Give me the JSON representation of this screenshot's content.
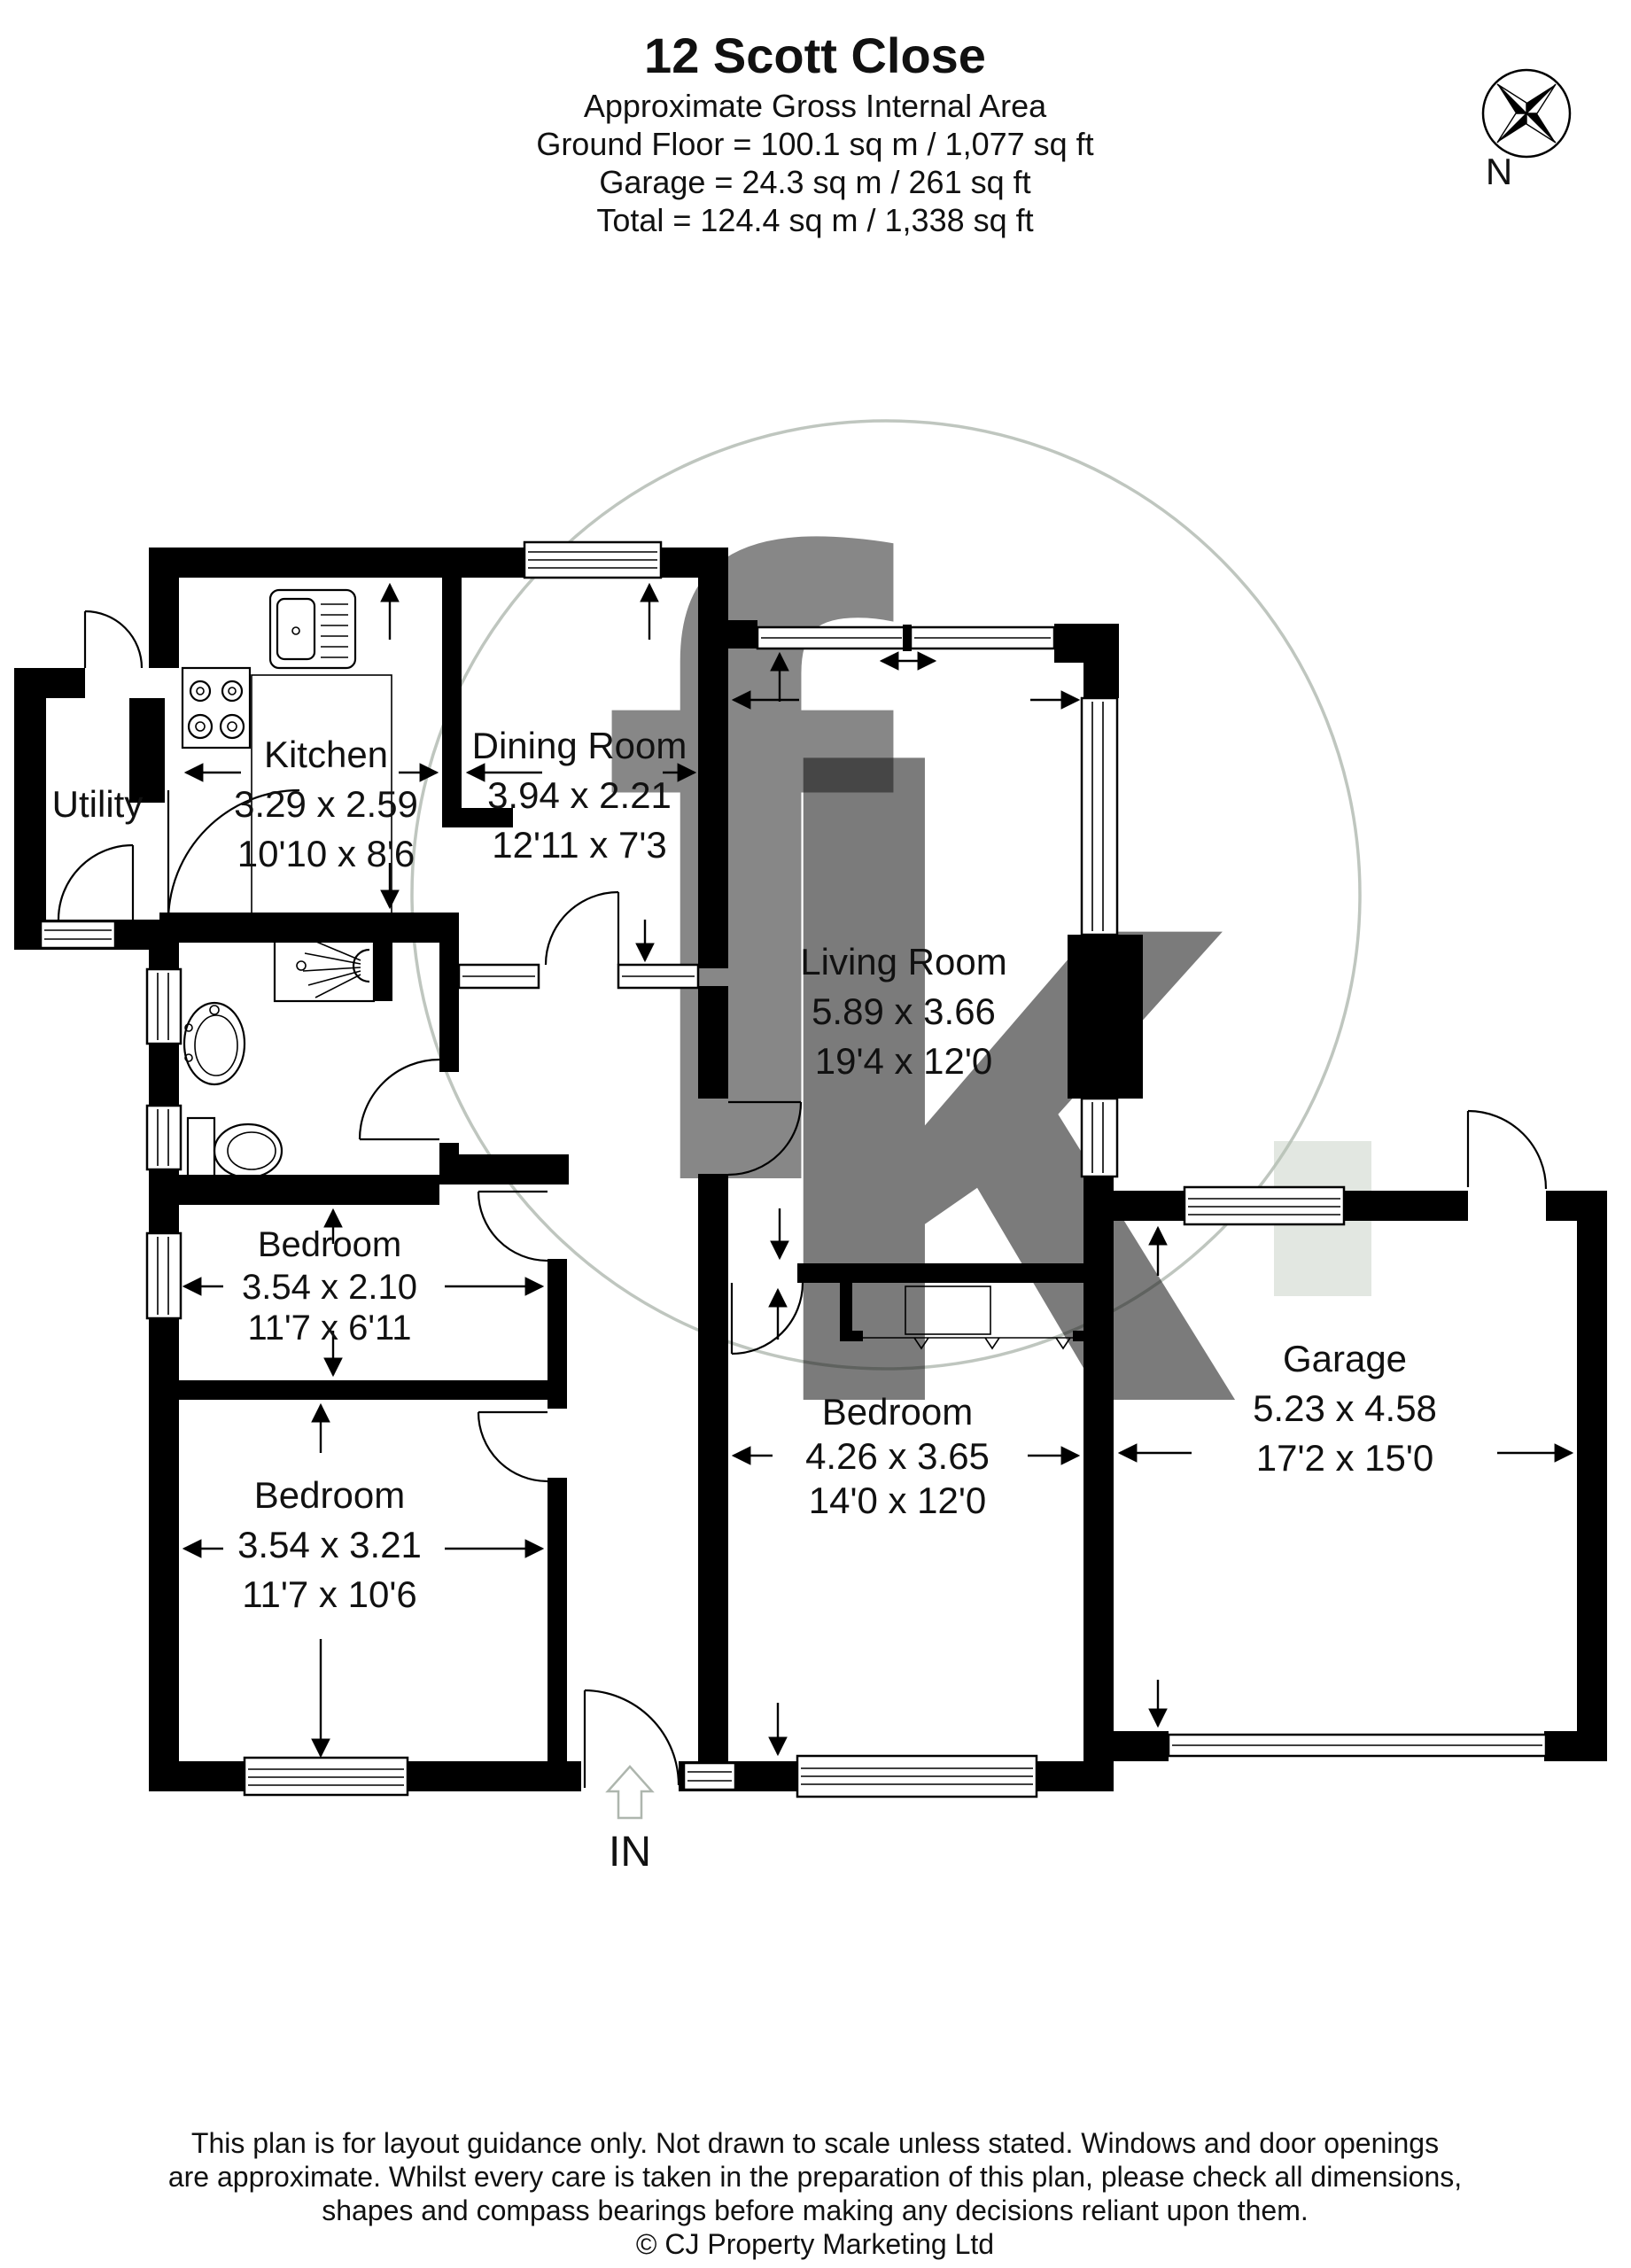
{
  "header": {
    "title": "12 Scott Close",
    "subtitle": "Approximate Gross Internal Area",
    "area_lines": [
      "Ground Floor = 100.1 sq m / 1,077 sq ft",
      "Garage = 24.3 sq m / 261 sq ft",
      "Total = 124.4 sq m / 1,338 sq ft"
    ]
  },
  "compass": {
    "label": "N"
  },
  "rooms": {
    "utility": {
      "name": "Utility"
    },
    "kitchen": {
      "name": "Kitchen",
      "metric": "3.29 x 2.59",
      "imperial": "10'10 x 8'6"
    },
    "dining": {
      "name": "Dining Room",
      "metric": "3.94 x 2.21",
      "imperial": "12'11 x 7'3"
    },
    "living": {
      "name": "Living Room",
      "metric": "5.89 x 3.66",
      "imperial": "19'4 x 12'0"
    },
    "bedroom1": {
      "name": "Bedroom",
      "metric": "3.54 x 2.10",
      "imperial": "11'7 x 6'11"
    },
    "bedroom2": {
      "name": "Bedroom",
      "metric": "3.54 x 3.21",
      "imperial": "11'7 x 10'6"
    },
    "bedroom3": {
      "name": "Bedroom",
      "metric": "4.26 x 3.65",
      "imperial": "14'0 x 12'0"
    },
    "garage": {
      "name": "Garage",
      "metric": "5.23 x 4.58",
      "imperial": "17'2 x 15'0"
    }
  },
  "entrance": {
    "label": "IN"
  },
  "watermark": {
    "letter_f": "f",
    "letter_k": "k"
  },
  "footer": {
    "disclaimer_lines": [
      "This plan is for layout guidance only. Not drawn to scale unless stated. Windows and door openings",
      "are approximate. Whilst every care is taken in the preparation of this plan, please check all dimensions,",
      "shapes and compass bearings before making any decisions reliant upon them."
    ],
    "copyright": "© CJ Property Marketing Ltd"
  },
  "colors": {
    "wall": "#000000",
    "text": "#111111",
    "watermark_grey": "#c3c7c3",
    "watermark_green": "#b7c3b3"
  }
}
